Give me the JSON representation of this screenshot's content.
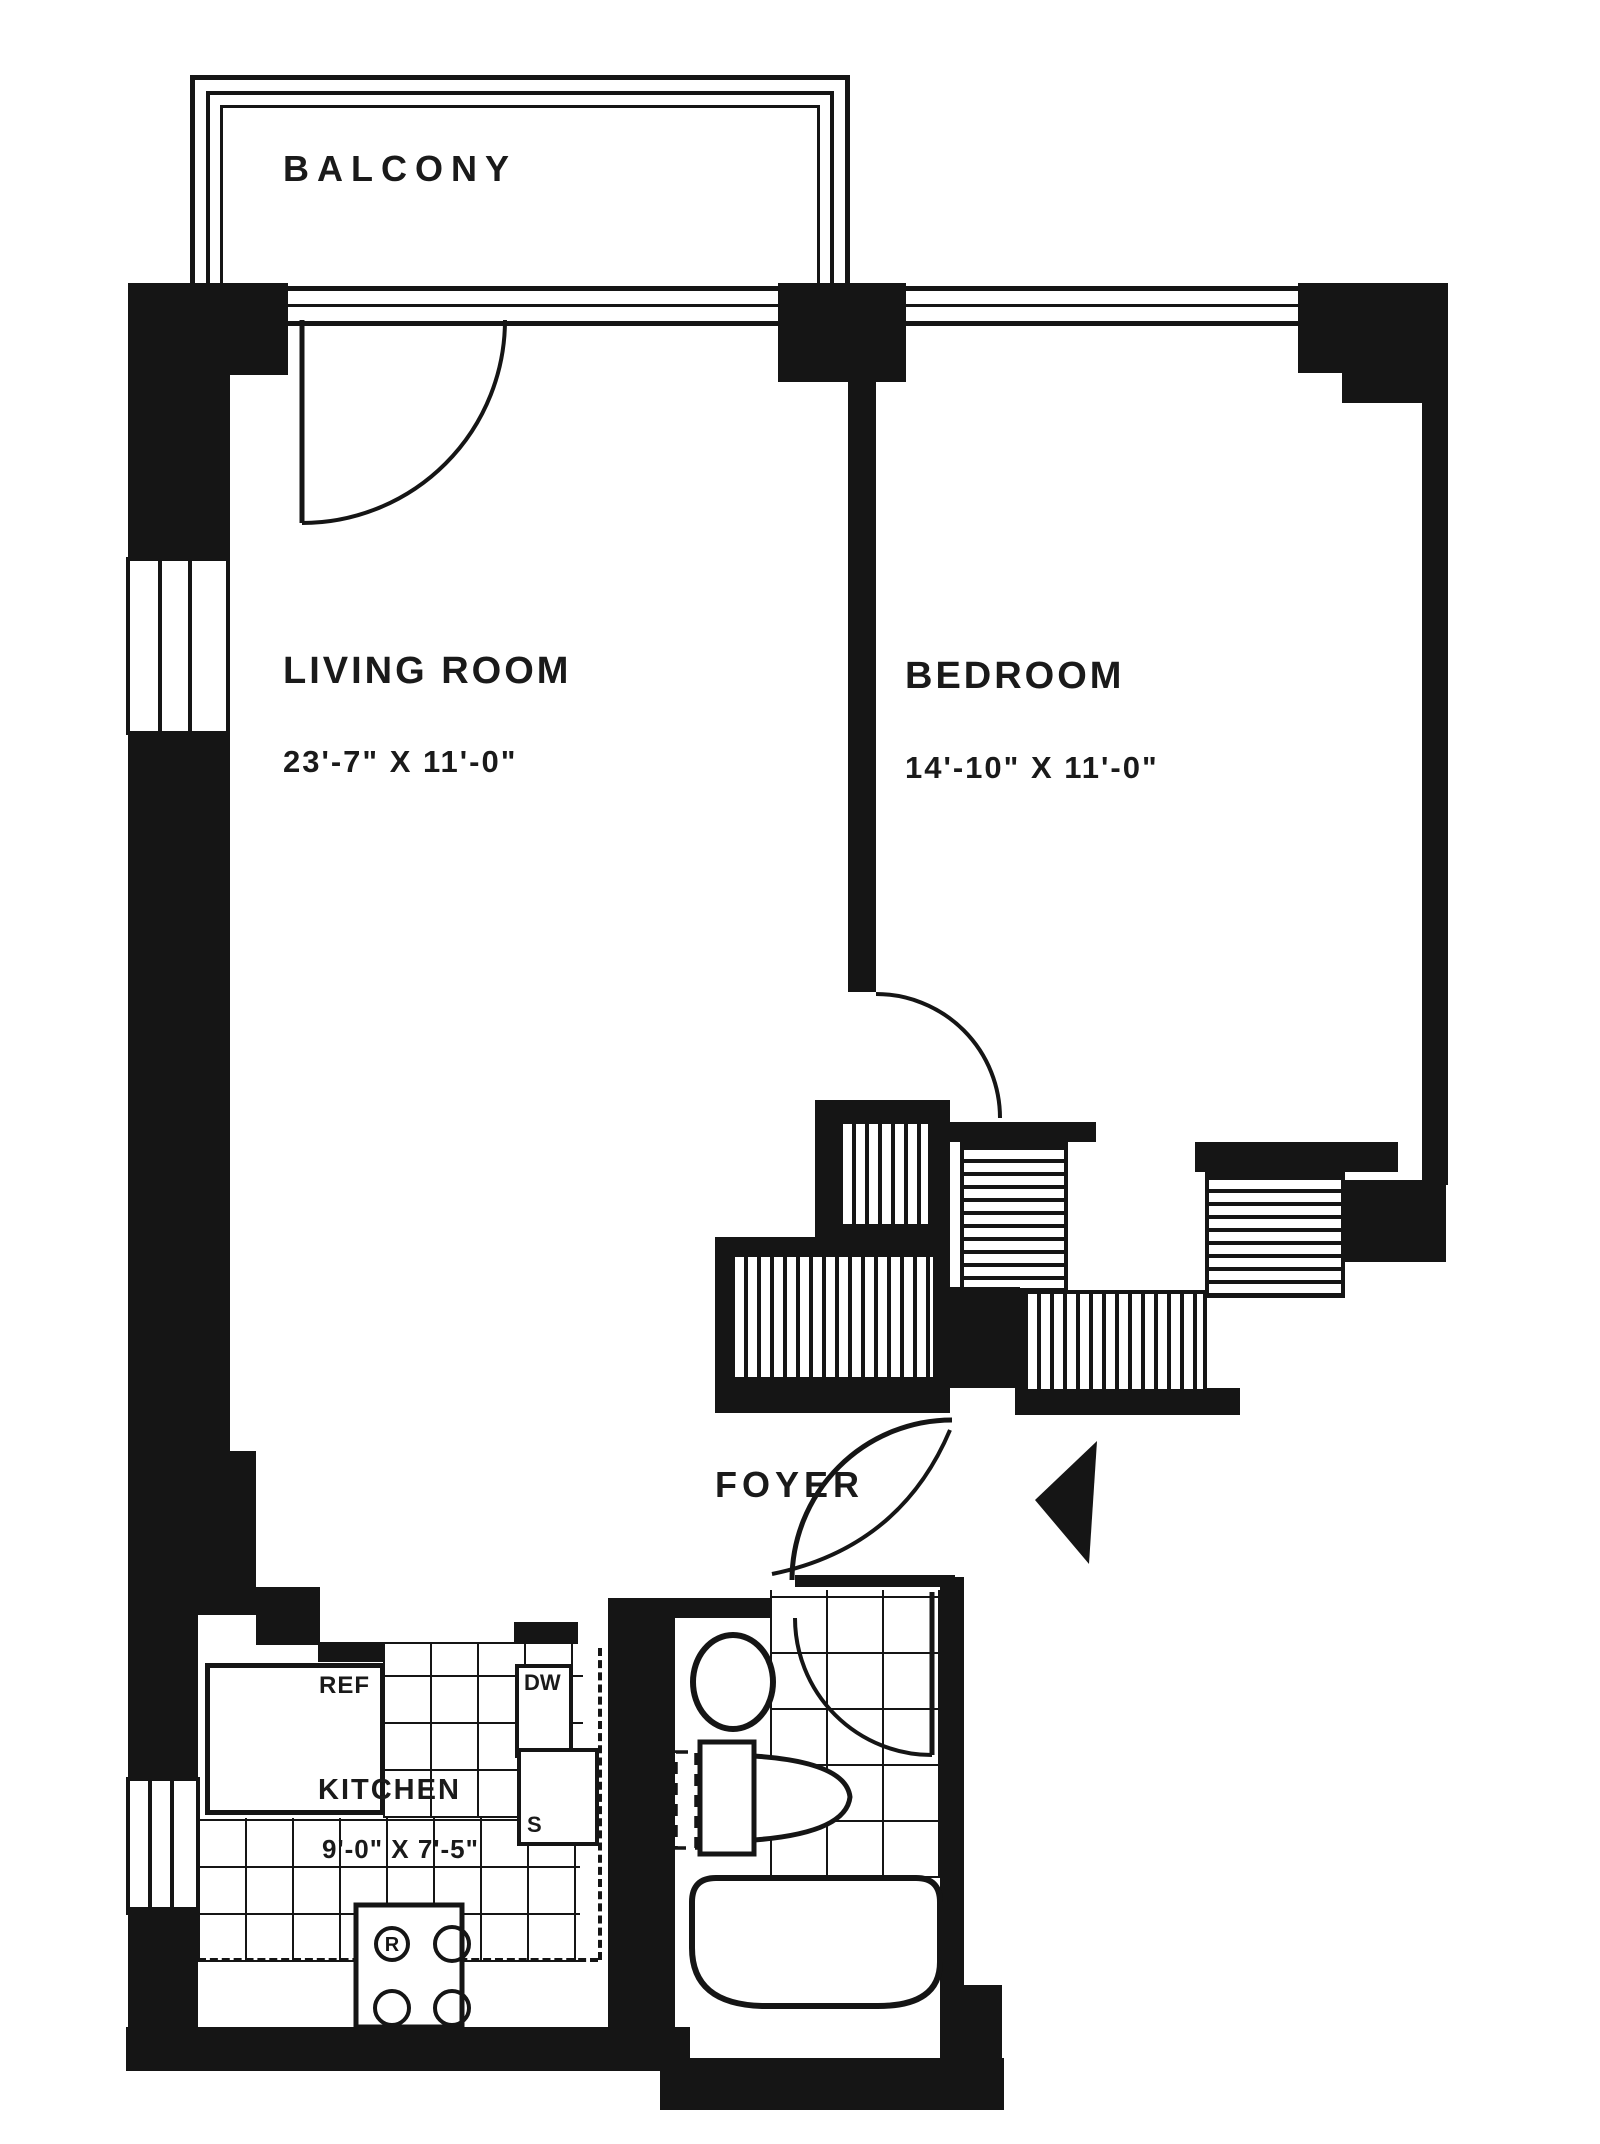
{
  "rooms": {
    "balcony": {
      "label": "BALCONY"
    },
    "living_room": {
      "label": "LIVING ROOM",
      "dimensions": "23'-7\" X 11'-0\""
    },
    "bedroom": {
      "label": "BEDROOM",
      "dimensions": "14'-10\" X 11'-0\""
    },
    "foyer": {
      "label": "FOYER"
    },
    "kitchen": {
      "label": "KITCHEN",
      "dimensions": "9'-0\" X 7'-5\""
    }
  },
  "appliances": {
    "refrigerator": "REF",
    "dishwasher": "DW",
    "sink": "S",
    "range": "R"
  },
  "colors": {
    "ink": "#151515",
    "paper": "#ffffff"
  }
}
